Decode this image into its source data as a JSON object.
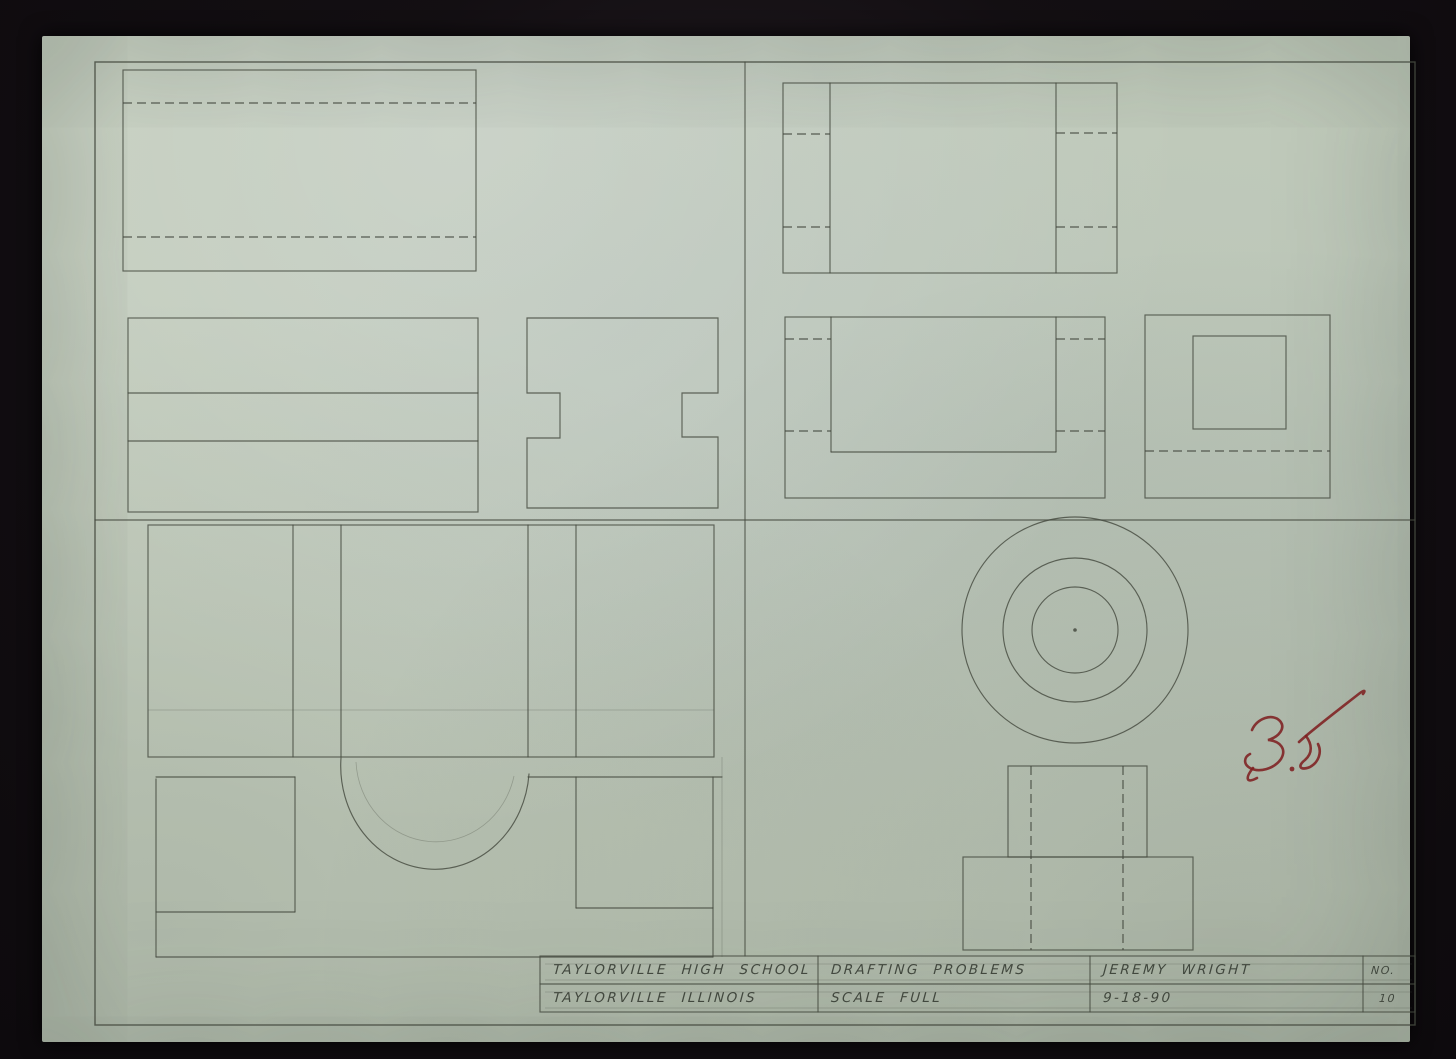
{
  "title_block": {
    "cells": {
      "school": {
        "line1": "TAYLORVILLE HIGH SCHOOL",
        "line2": "TAYLORVILLE ILLINOIS"
      },
      "project": {
        "line1": "DRAFTING PROBLEMS",
        "line2": "SCALE FULL"
      },
      "author": {
        "line1": "JEREMY WRIGHT",
        "line2": "9-18-90"
      },
      "number": {
        "label": "NO.",
        "value": "10"
      }
    }
  },
  "grade_mark": {
    "value": "35",
    "color": "#7e2021"
  },
  "paper": {
    "color": "#c1cbbb",
    "pencil_color": "#454a40"
  },
  "drawing": {
    "groups": [
      {
        "name": "sheet-frame",
        "elements": [
          {
            "t": "rect",
            "x": 95,
            "y": 62,
            "w": 1320,
            "h": 963,
            "cls": "frame"
          },
          {
            "t": "line",
            "x1": 745,
            "y1": 62,
            "x2": 745,
            "y2": 956,
            "cls": "pencil"
          },
          {
            "t": "line",
            "x1": 95,
            "y1": 520,
            "x2": 1415,
            "y2": 520,
            "cls": "pencil"
          }
        ]
      },
      {
        "name": "title-block-borders",
        "elements": [
          {
            "t": "rect",
            "x": 540,
            "y": 956,
            "w": 875,
            "h": 56,
            "cls": "pencil"
          },
          {
            "t": "line",
            "x1": 540,
            "y1": 984,
            "x2": 1415,
            "y2": 984,
            "cls": "pencil"
          },
          {
            "t": "line",
            "x1": 818,
            "y1": 956,
            "x2": 818,
            "y2": 1012,
            "cls": "pencil"
          },
          {
            "t": "line",
            "x1": 1090,
            "y1": 956,
            "x2": 1090,
            "y2": 1012,
            "cls": "pencil"
          },
          {
            "t": "line",
            "x1": 1363,
            "y1": 956,
            "x2": 1363,
            "y2": 1012,
            "cls": "pencil"
          },
          {
            "t": "line",
            "x1": 545,
            "y1": 964,
            "x2": 1412,
            "y2": 964,
            "cls": "light"
          },
          {
            "t": "line",
            "x1": 545,
            "y1": 980,
            "x2": 1412,
            "y2": 980,
            "cls": "light"
          },
          {
            "t": "line",
            "x1": 545,
            "y1": 992,
            "x2": 1412,
            "y2": 992,
            "cls": "light"
          },
          {
            "t": "line",
            "x1": 545,
            "y1": 1008,
            "x2": 1412,
            "y2": 1008,
            "cls": "light"
          }
        ]
      },
      {
        "name": "problem-1-top-view",
        "elements": [
          {
            "t": "rect",
            "x": 123,
            "y": 70,
            "w": 353,
            "h": 201,
            "cls": "pencil"
          },
          {
            "t": "line",
            "x1": 123,
            "y1": 103,
            "x2": 476,
            "y2": 103,
            "cls": "dashed"
          },
          {
            "t": "line",
            "x1": 123,
            "y1": 237,
            "x2": 476,
            "y2": 237,
            "cls": "dashed"
          }
        ]
      },
      {
        "name": "problem-1-front-view",
        "elements": [
          {
            "t": "rect",
            "x": 128,
            "y": 318,
            "w": 350,
            "h": 194,
            "cls": "pencil"
          },
          {
            "t": "line",
            "x1": 128,
            "y1": 393,
            "x2": 478,
            "y2": 393,
            "cls": "pencil"
          },
          {
            "t": "line",
            "x1": 128,
            "y1": 441,
            "x2": 478,
            "y2": 441,
            "cls": "pencil"
          }
        ]
      },
      {
        "name": "problem-1-side-view",
        "elements": [
          {
            "t": "path",
            "d": "M527,318 H718 V393 H682 V437 H718 V508 H527 V438 H560 V393 H527 Z",
            "cls": "pencil"
          }
        ]
      },
      {
        "name": "problem-2-top-view",
        "elements": [
          {
            "t": "rect",
            "x": 783,
            "y": 83,
            "w": 334,
            "h": 190,
            "cls": "pencil"
          },
          {
            "t": "line",
            "x1": 830,
            "y1": 83,
            "x2": 830,
            "y2": 273,
            "cls": "pencil"
          },
          {
            "t": "line",
            "x1": 1056,
            "y1": 83,
            "x2": 1056,
            "y2": 273,
            "cls": "pencil"
          },
          {
            "t": "line",
            "x1": 783,
            "y1": 134,
            "x2": 830,
            "y2": 134,
            "cls": "dashed"
          },
          {
            "t": "line",
            "x1": 1056,
            "y1": 133,
            "x2": 1117,
            "y2": 133,
            "cls": "dashed"
          },
          {
            "t": "line",
            "x1": 783,
            "y1": 227,
            "x2": 830,
            "y2": 227,
            "cls": "dashed"
          },
          {
            "t": "line",
            "x1": 1056,
            "y1": 227,
            "x2": 1117,
            "y2": 227,
            "cls": "dashed"
          }
        ]
      },
      {
        "name": "problem-2-front-view",
        "elements": [
          {
            "t": "rect",
            "x": 785,
            "y": 317,
            "w": 320,
            "h": 181,
            "cls": "pencil"
          },
          {
            "t": "line",
            "x1": 831,
            "y1": 317,
            "x2": 831,
            "y2": 452,
            "cls": "pencil"
          },
          {
            "t": "line",
            "x1": 1056,
            "y1": 317,
            "x2": 1056,
            "y2": 452,
            "cls": "pencil"
          },
          {
            "t": "line",
            "x1": 831,
            "y1": 452,
            "x2": 1056,
            "y2": 452,
            "cls": "pencil"
          },
          {
            "t": "line",
            "x1": 785,
            "y1": 339,
            "x2": 831,
            "y2": 339,
            "cls": "dashed"
          },
          {
            "t": "line",
            "x1": 1056,
            "y1": 339,
            "x2": 1105,
            "y2": 339,
            "cls": "dashed"
          },
          {
            "t": "line",
            "x1": 785,
            "y1": 431,
            "x2": 831,
            "y2": 431,
            "cls": "dashed"
          },
          {
            "t": "line",
            "x1": 1056,
            "y1": 431,
            "x2": 1105,
            "y2": 431,
            "cls": "dashed"
          }
        ]
      },
      {
        "name": "problem-2-side-view",
        "elements": [
          {
            "t": "rect",
            "x": 1145,
            "y": 315,
            "w": 185,
            "h": 183,
            "cls": "pencil"
          },
          {
            "t": "rect",
            "x": 1193,
            "y": 336,
            "w": 93,
            "h": 93,
            "cls": "pencil"
          },
          {
            "t": "line",
            "x1": 1145,
            "y1": 451,
            "x2": 1330,
            "y2": 451,
            "cls": "dashed"
          }
        ]
      },
      {
        "name": "problem-3-top-view",
        "elements": [
          {
            "t": "rect",
            "x": 148,
            "y": 525,
            "w": 566,
            "h": 232,
            "cls": "pencil"
          },
          {
            "t": "line",
            "x1": 293,
            "y1": 525,
            "x2": 293,
            "y2": 757,
            "cls": "pencil"
          },
          {
            "t": "line",
            "x1": 341,
            "y1": 525,
            "x2": 341,
            "y2": 757,
            "cls": "pencil"
          },
          {
            "t": "line",
            "x1": 528,
            "y1": 525,
            "x2": 528,
            "y2": 757,
            "cls": "pencil"
          },
          {
            "t": "line",
            "x1": 576,
            "y1": 525,
            "x2": 576,
            "y2": 757,
            "cls": "pencil"
          },
          {
            "t": "line",
            "x1": 148,
            "y1": 710,
            "x2": 714,
            "y2": 710,
            "cls": "light"
          }
        ]
      },
      {
        "name": "problem-3-front-view",
        "elements": [
          {
            "t": "line",
            "x1": 156,
            "y1": 777,
            "x2": 295,
            "y2": 777,
            "cls": "pencil"
          },
          {
            "t": "line",
            "x1": 528,
            "y1": 777,
            "x2": 722,
            "y2": 777,
            "cls": "pencil"
          },
          {
            "t": "path",
            "d": "M341,758 A94,103 0 0 0 529,774",
            "cls": "pencil"
          },
          {
            "t": "path",
            "d": "M356,762 A80,84 0 0 0 514,776",
            "cls": "light"
          },
          {
            "t": "line",
            "x1": 295,
            "y1": 777,
            "x2": 295,
            "y2": 912,
            "cls": "pencil"
          },
          {
            "t": "line",
            "x1": 576,
            "y1": 777,
            "x2": 576,
            "y2": 908,
            "cls": "pencil"
          },
          {
            "t": "line",
            "x1": 156,
            "y1": 912,
            "x2": 295,
            "y2": 912,
            "cls": "pencil"
          },
          {
            "t": "line",
            "x1": 576,
            "y1": 908,
            "x2": 713,
            "y2": 908,
            "cls": "pencil"
          },
          {
            "t": "line",
            "x1": 156,
            "y1": 779,
            "x2": 156,
            "y2": 957,
            "cls": "pencil"
          },
          {
            "t": "line",
            "x1": 713,
            "y1": 777,
            "x2": 713,
            "y2": 957,
            "cls": "pencil"
          },
          {
            "t": "line",
            "x1": 722,
            "y1": 757,
            "x2": 722,
            "y2": 957,
            "cls": "light"
          },
          {
            "t": "line",
            "x1": 156,
            "y1": 957,
            "x2": 713,
            "y2": 957,
            "cls": "pencil"
          }
        ]
      },
      {
        "name": "problem-4-top-view-circles",
        "elements": [
          {
            "t": "circle",
            "cx": 1075,
            "cy": 630,
            "r": 113,
            "cls": "pencil"
          },
          {
            "t": "circle",
            "cx": 1075,
            "cy": 630,
            "r": 72,
            "cls": "pencil"
          },
          {
            "t": "circle",
            "cx": 1075,
            "cy": 630,
            "r": 43,
            "cls": "pencil"
          },
          {
            "t": "dot",
            "cx": 1075,
            "cy": 630,
            "r": 1.8,
            "cls": "pencil-dot"
          }
        ]
      },
      {
        "name": "problem-4-front-view",
        "elements": [
          {
            "t": "rect",
            "x": 1008,
            "y": 766,
            "w": 139,
            "h": 91,
            "cls": "pencil"
          },
          {
            "t": "rect",
            "x": 963,
            "y": 857,
            "w": 230,
            "h": 93,
            "cls": "pencil"
          },
          {
            "t": "line",
            "x1": 1031,
            "y1": 766,
            "x2": 1031,
            "y2": 950,
            "cls": "dashed"
          },
          {
            "t": "line",
            "x1": 1123,
            "y1": 766,
            "x2": 1123,
            "y2": 950,
            "cls": "dashed"
          }
        ]
      },
      {
        "name": "grade-mark-35",
        "elements": [
          {
            "t": "path",
            "d": "M1252,730 C1257,718 1273,713 1280,721 C1286,728 1279,737 1268,740 C1280,741 1287,749 1281,759 C1274,769 1259,773 1250,768 C1243,764 1244,757 1250,754",
            "cls": "red"
          },
          {
            "t": "path",
            "d": "M1253,768 C1245,778 1246,784 1257,778",
            "cls": "red"
          },
          {
            "t": "dot",
            "cx": 1292,
            "cy": 769,
            "r": 2.4,
            "cls": "red-dot"
          },
          {
            "t": "path",
            "d": "M1306,736 C1312,744 1313,753 1305,760 C1297,766 1300,771 1310,767 C1319,762 1322,752 1318,744",
            "cls": "red"
          },
          {
            "t": "path",
            "d": "M1299,742 C1312,730 1337,711 1360,693 C1364,690 1366,690 1363,694",
            "cls": "red"
          }
        ]
      }
    ]
  }
}
